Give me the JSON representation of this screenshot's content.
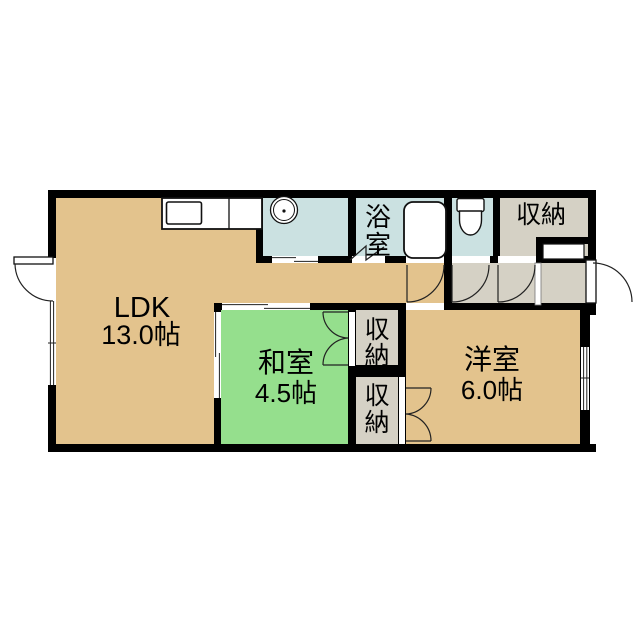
{
  "colors": {
    "wall": "#000000",
    "ldk_floor": "#E3C38D",
    "tatami_floor": "#95DF8D",
    "wet_floor": "#CBE1E1",
    "storage_floor": "#D5D1C5"
  },
  "rooms": {
    "ldk": {
      "name": "LDK",
      "size": "13.0帖"
    },
    "japanese_room": {
      "name": "和室",
      "size": "4.5帖"
    },
    "western_room": {
      "name": "洋室",
      "size": "6.0帖"
    },
    "bathroom": {
      "name": "浴室",
      "chars": [
        "浴",
        "室"
      ]
    },
    "entrance_storage": {
      "name": "収納"
    },
    "closet_upper": {
      "name": "収納",
      "chars": [
        "収",
        "納"
      ]
    },
    "closet_lower": {
      "name": "収納",
      "chars": [
        "収",
        "納"
      ]
    }
  }
}
